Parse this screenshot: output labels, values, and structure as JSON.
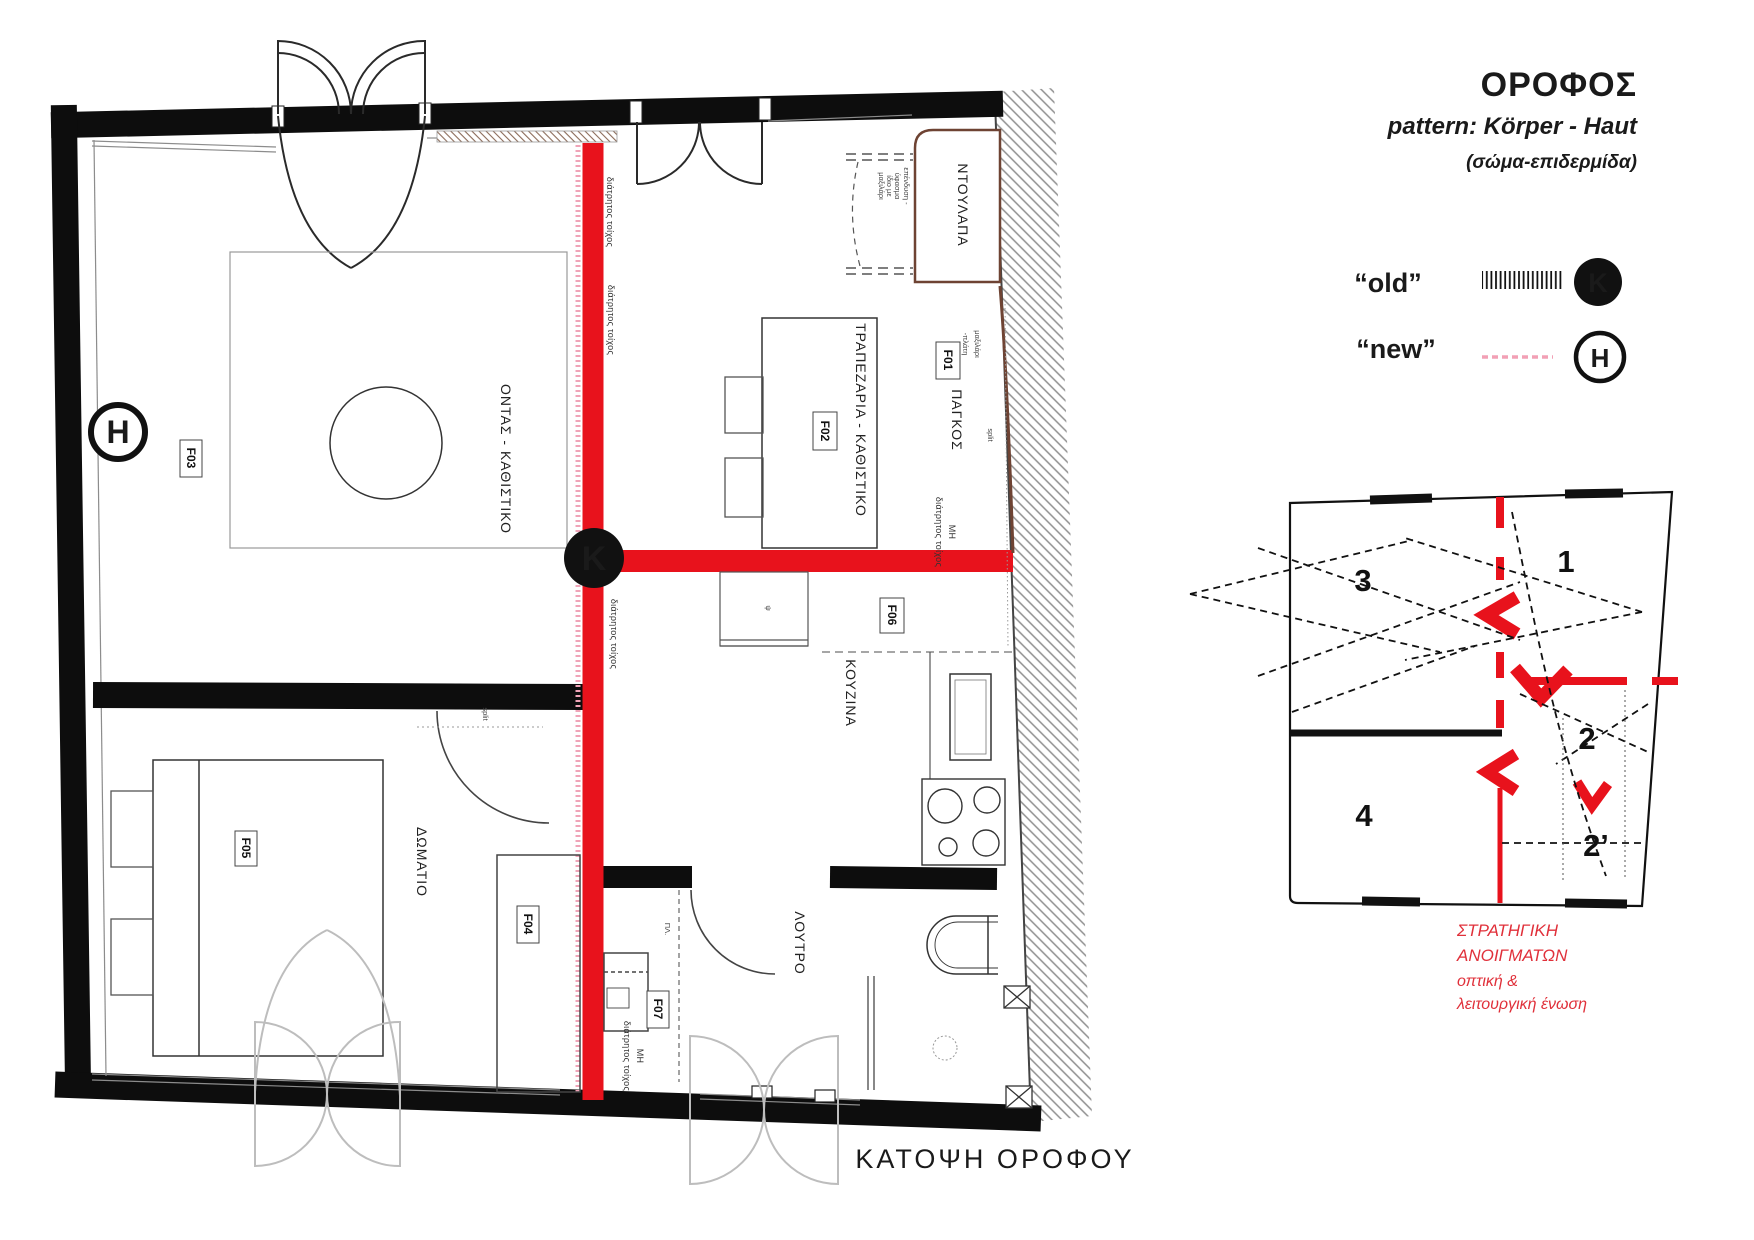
{
  "header": {
    "title": "ΟΡΟΦΟΣ",
    "pattern": "pattern: Körper - Haut",
    "subtitle": "(σώμα-επιδερμίδα)"
  },
  "legend": {
    "old_label": "“old”",
    "old_symbol": "K",
    "new_label": "“new”",
    "new_symbol": "H"
  },
  "plan": {
    "caption": "ΚΑΤΟΨΗ ΟΡΟΦΟΥ",
    "markers": {
      "h": "H",
      "k": "K"
    },
    "rooms": {
      "living": "ΟΝΤΑΣ - ΚΑΘΙΣΤΙΚΟ",
      "dining": "ΤΡΑΠΕΖΑΡΙΑ - ΚΑΘΙΣΤΙΚΟ",
      "kitchen": "ΚΟΥΖΙΝΑ",
      "bedroom": "ΔΩΜΑΤΙΟ",
      "bathroom": "ΛΟΥΤΡΟ",
      "closet": "ΝΤΟΥΛΑΠΑ",
      "bench": "ΠΑΓΚΟΣ"
    },
    "fixtures": {
      "f01": "F01",
      "f02": "F02",
      "f03": "F03",
      "f04": "F04",
      "f05": "F05",
      "f06": "F06",
      "f07": "F07"
    },
    "notes": {
      "perforated": "διάτρητος τοίχος",
      "not_prefix": "ΜΗ",
      "split": "split",
      "upholstery_l1": "επένδυση -",
      "upholstery_l2": "ύφασμα",
      "upholstery_l3": "ίδιο με",
      "upholstery_l4": "μαξιλάρι",
      "cushion_l1": "μαξιλάρι",
      "cushion_l2": "-πλάτη",
      "washer": "ΠΛ.",
      "psi": "ψ"
    }
  },
  "diagram": {
    "zones": {
      "z1": "1",
      "z2": "2",
      "z2p": "2’",
      "z3": "3",
      "z4": "4"
    },
    "note_l1": "ΣΤΡΑΤΗΓΙΚΗ",
    "note_l2": "ΑΝΟΙΓΜΑΤΩΝ",
    "note_l3": "οπτική &",
    "note_l4": "λειτουργική ένωση"
  },
  "colors": {
    "new_wall": "#e8121c",
    "new_dash": "#f2a0b5",
    "old_wall": "#0d0d0d",
    "bench_line": "#6e4333"
  }
}
